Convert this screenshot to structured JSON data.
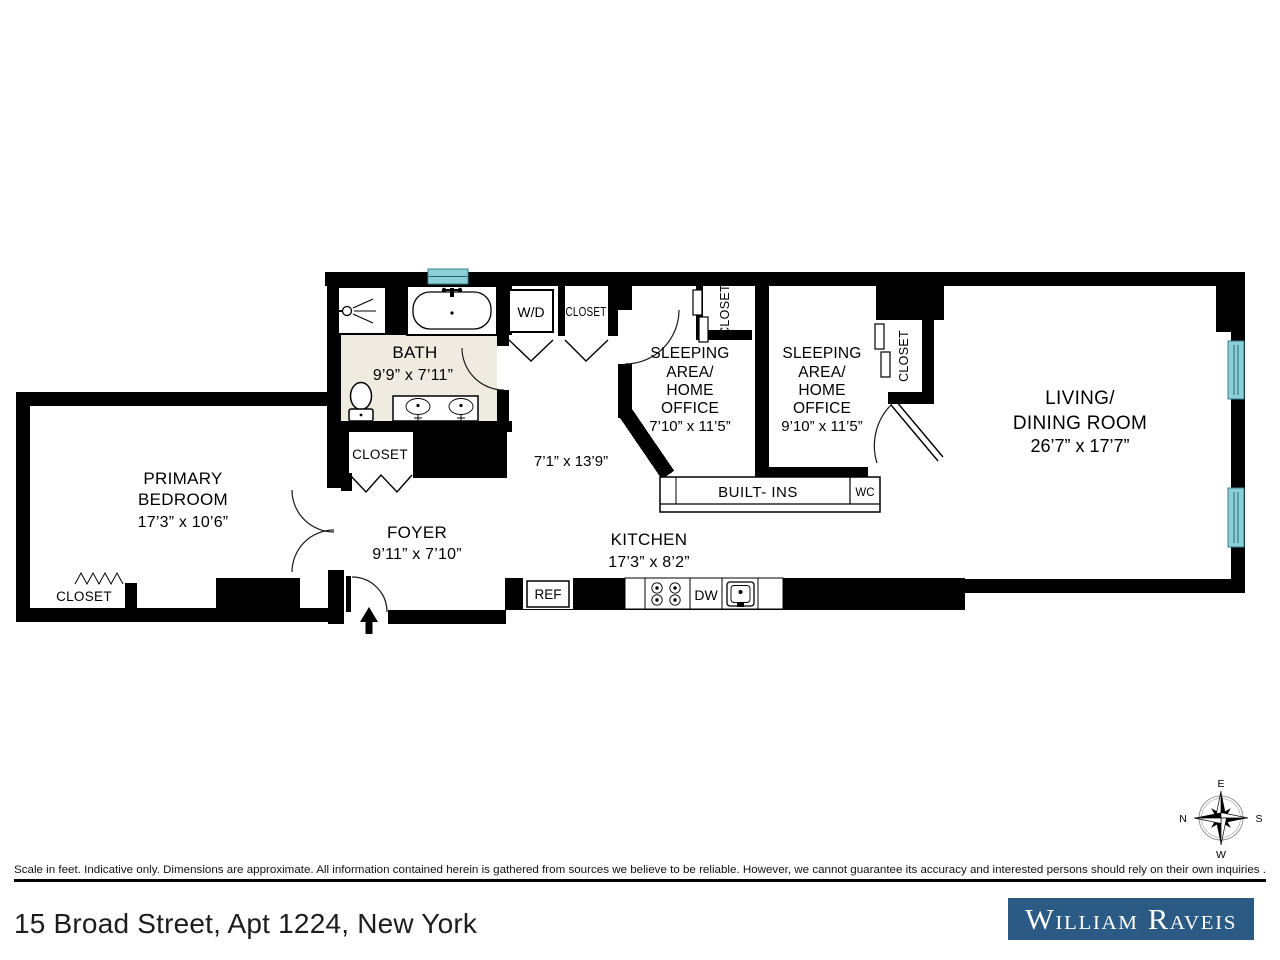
{
  "plan": {
    "colors": {
      "wall": "#000000",
      "window": "#8ccfd8",
      "window_edge": "#39808d",
      "bath_floor": "#f0ebe0"
    },
    "rooms": {
      "primary_bedroom": {
        "l1": "PRIMARY",
        "l2": "BEDROOM",
        "dims": "17’3” x 10’6”"
      },
      "bath": {
        "l1": "BATH",
        "dims": "9’9” x 7’11”"
      },
      "foyer": {
        "l1": "FOYER",
        "dims": "9’11” x 7’10”"
      },
      "hall": {
        "dims": "7’1” x 13’9”"
      },
      "kitchen": {
        "l1": "KITCHEN",
        "dims": "17’3” x 8’2”"
      },
      "sleeping_area_1": {
        "l1": "SLEEPING",
        "l2": "AREA/",
        "l3": "HOME",
        "l4": "OFFICE",
        "dims": "7’10” x 11’5”"
      },
      "sleeping_area_2": {
        "l1": "SLEEPING",
        "l2": "AREA/",
        "l3": "HOME",
        "l4": "OFFICE",
        "dims": "9’10” x 11’5”"
      },
      "living_dining": {
        "l1": "LIVING/",
        "l2": "DINING ROOM",
        "dims": "26’7” x 17’7”"
      }
    },
    "labels": {
      "closet": "CLOSET",
      "wd": "W/D",
      "ref": "REF",
      "dw": "DW",
      "wc": "WC",
      "builtins": "BUILT- INS"
    },
    "compass": {
      "n": "N",
      "e": "E",
      "s": "S",
      "w": "W"
    }
  },
  "footer": {
    "disclaimer": "Scale in feet. Indicative only. Dimensions are approximate. All information contained herein is gathered from sources we believe to be reliable. However, we cannot guarantee its accuracy and interested persons should rely on their own inquiries .",
    "address": "15 Broad Street, Apt 1224, New York",
    "brand": "William Raveis",
    "brand_bg": "#2b5b84"
  }
}
